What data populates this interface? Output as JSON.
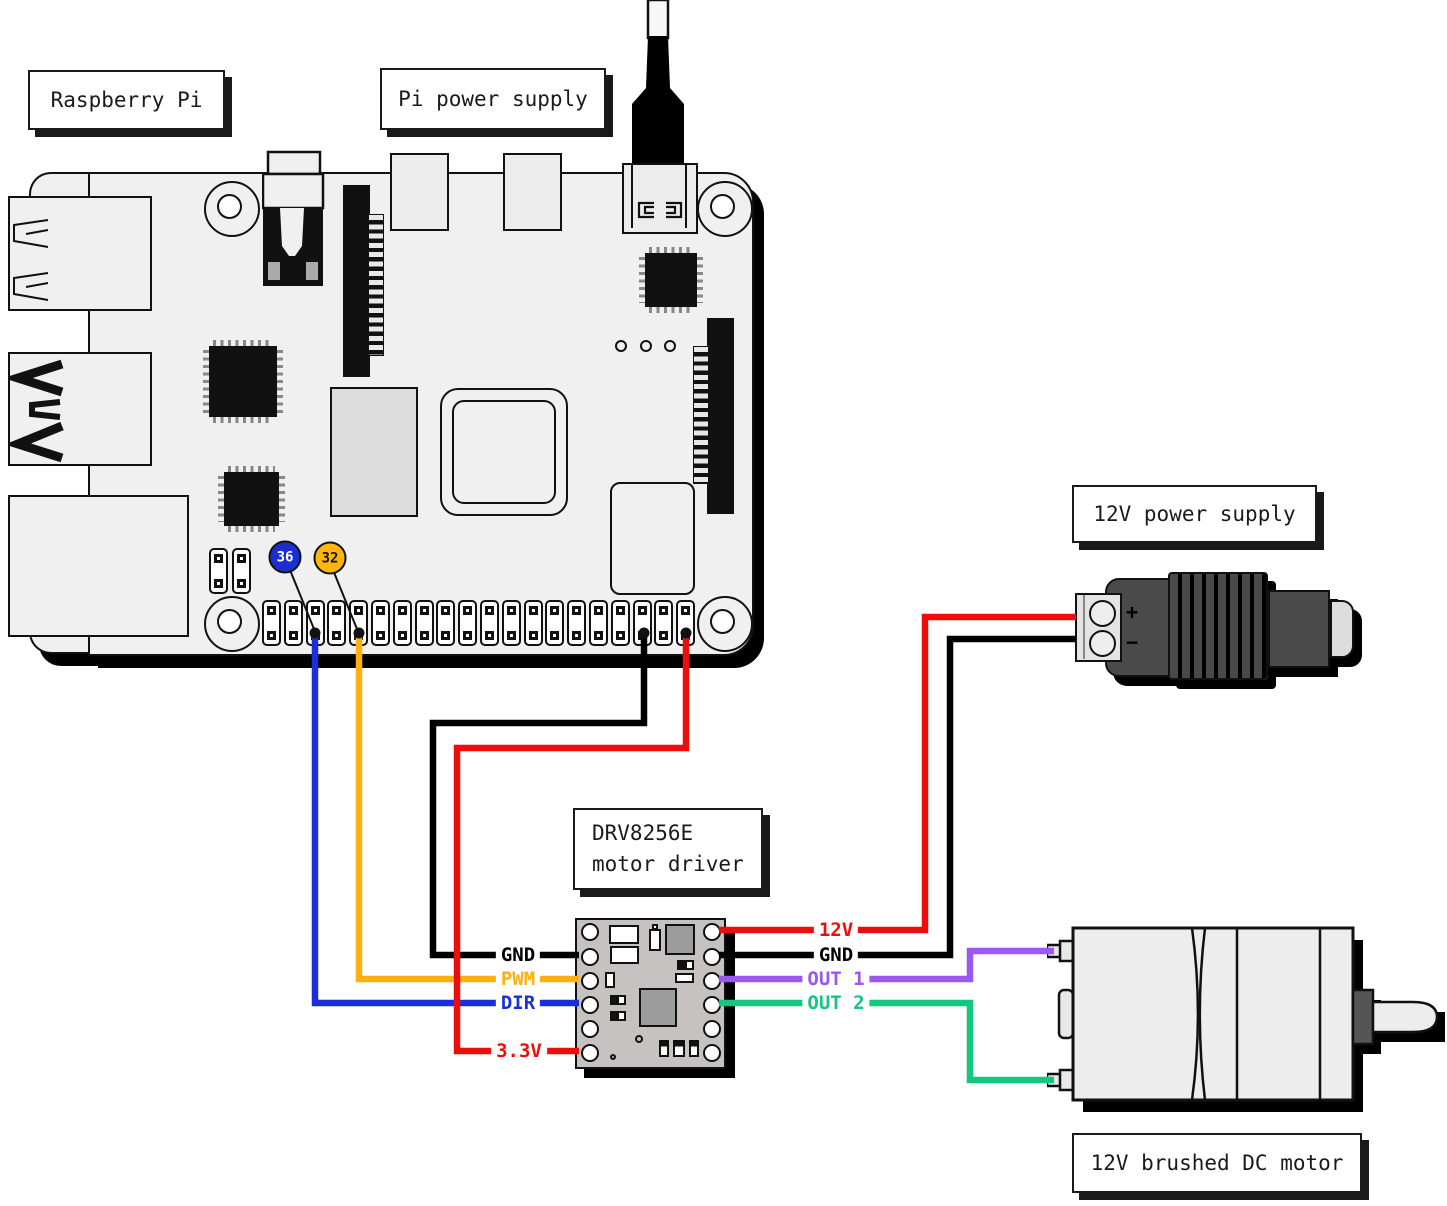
{
  "boxes": {
    "raspberry_pi": "Raspberry Pi",
    "pi_power_supply": "Pi power supply",
    "supply_12v": "12V power supply",
    "driver_line1": "DRV8256E",
    "driver_line2": "motor driver",
    "motor": "12V brushed DC motor"
  },
  "wires": {
    "dir": {
      "label": "DIR",
      "color": "#1b2fd8"
    },
    "pwm": {
      "label": "PWM",
      "color": "#fcb10f"
    },
    "gnd_pi": {
      "label": "GND",
      "color": "#000000"
    },
    "v33": {
      "label": "3.3V",
      "color": "#ee0d0d"
    },
    "v12": {
      "label": "12V",
      "color": "#ee0d0d"
    },
    "gnd_supply": {
      "label": "GND",
      "color": "#000000"
    },
    "out1": {
      "label": "OUT 1",
      "color": "#9a57f2"
    },
    "out2": {
      "label": "OUT 2",
      "color": "#14c77e"
    }
  },
  "badges": {
    "pin36": {
      "label": "36",
      "color": "#1b2fd0",
      "text_color": "#ffffff"
    },
    "pin32": {
      "label": "32",
      "color": "#ffb50c",
      "text_color": "#111111"
    }
  },
  "supply": {
    "plus": "+",
    "minus": "−"
  },
  "gpio": {
    "pin_pairs": 20,
    "aux_pin_pairs": 2
  }
}
